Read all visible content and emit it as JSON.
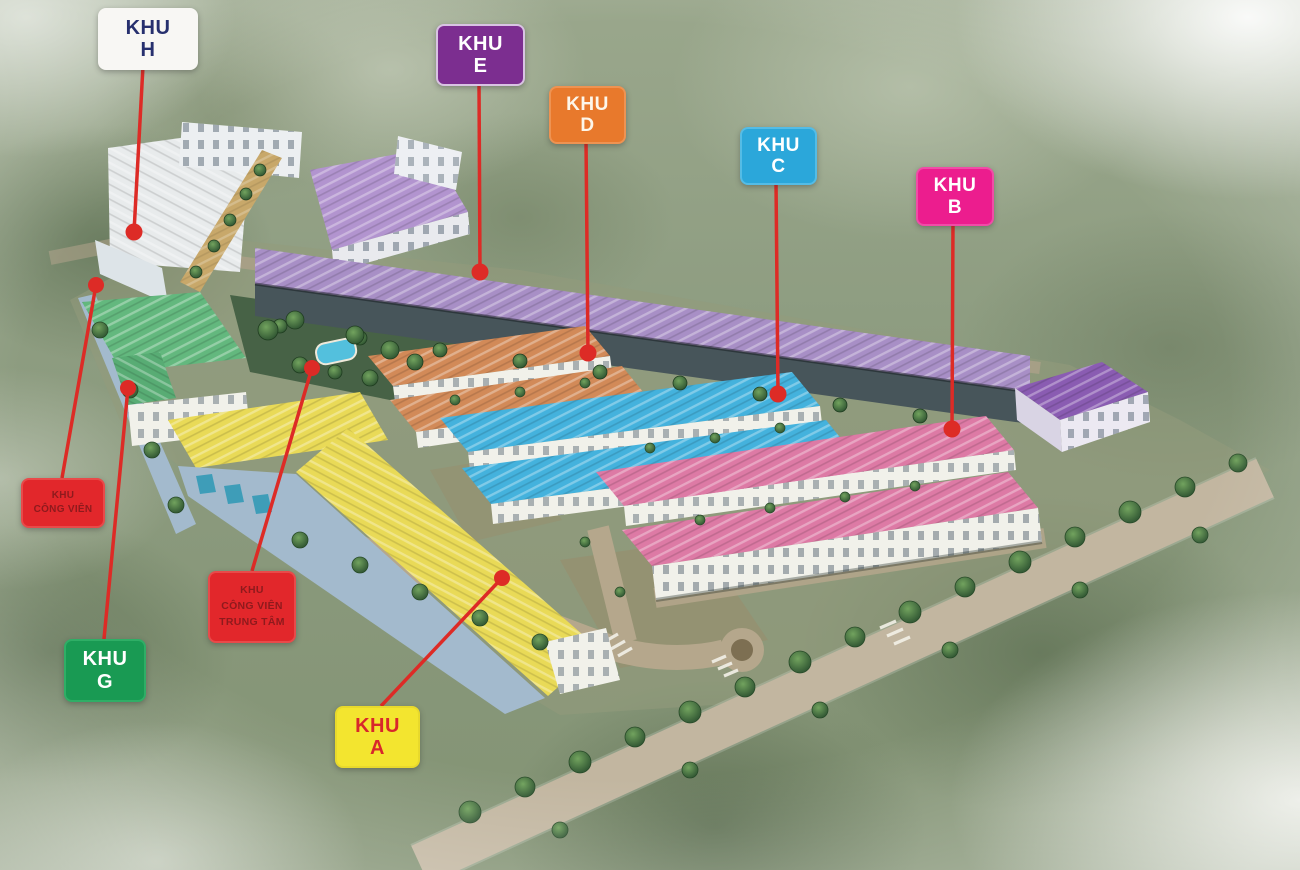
{
  "zones": {
    "h": {
      "line1": "KHU",
      "line2": "H",
      "box_bg": "#f8f7f4",
      "box_text": "#27306e",
      "box_border": "#f8f7f4",
      "roof": "#e8ebec"
    },
    "e": {
      "line1": "KHU",
      "line2": "E",
      "box_bg": "#7c2e90",
      "box_text": "#ffffff",
      "box_border": "#d9c3e3",
      "roof": "#a88fc6"
    },
    "d": {
      "line1": "KHU",
      "line2": "D",
      "box_bg": "#e8792c",
      "box_text": "#fdf6ea",
      "box_border": "#ee9352",
      "roof": "#d28a58"
    },
    "c": {
      "line1": "KHU",
      "line2": "C",
      "box_bg": "#2ba7da",
      "box_text": "#ffffff",
      "box_border": "#54bce6",
      "roof": "#44b2dd"
    },
    "b": {
      "line1": "KHU",
      "line2": "B",
      "box_bg": "#ec1d8e",
      "box_text": "#ffffff",
      "box_border": "#f04ca7",
      "roof": "#dd7aa5"
    },
    "g": {
      "line1": "KHU",
      "line2": "G",
      "box_bg": "#199a53",
      "box_text": "#ffffff",
      "box_border": "#2fae66",
      "roof": "#63b87e"
    },
    "a": {
      "line1": "KHU",
      "line2": "A",
      "box_bg": "#f3e52f",
      "box_text": "#d8272b",
      "box_border": "#e8d92c",
      "roof": "#e9da57"
    },
    "park_side": {
      "line1": "KHU",
      "line2": "CÔNG VIÊN",
      "box_bg": "#e2272b",
      "box_text": "#8e1a1d",
      "box_border": "#e84a4a"
    },
    "park_center": {
      "line1": "KHU",
      "line2": "CÔNG VIÊN",
      "line3": "TRUNG TÂM",
      "box_bg": "#e2272b",
      "box_text": "#8e1a1d",
      "box_border": "#e84a4a"
    }
  },
  "leader": {
    "color": "#dd2b26"
  },
  "scene": {
    "facade": "#f1f1ea",
    "facade_dark": "#47555a",
    "big_purple_roof": "#b294cf",
    "purple_block_roof": "#8a5cb2",
    "teal_roof": "#3e9db8",
    "wall": "#a3bacd",
    "road": "#b5a78c",
    "pool": "#53c0dd",
    "park_green": "#3f5c40",
    "tan_houses": "#c8a86a",
    "ground": "#939a7c",
    "dirt": "#9b8a68"
  }
}
